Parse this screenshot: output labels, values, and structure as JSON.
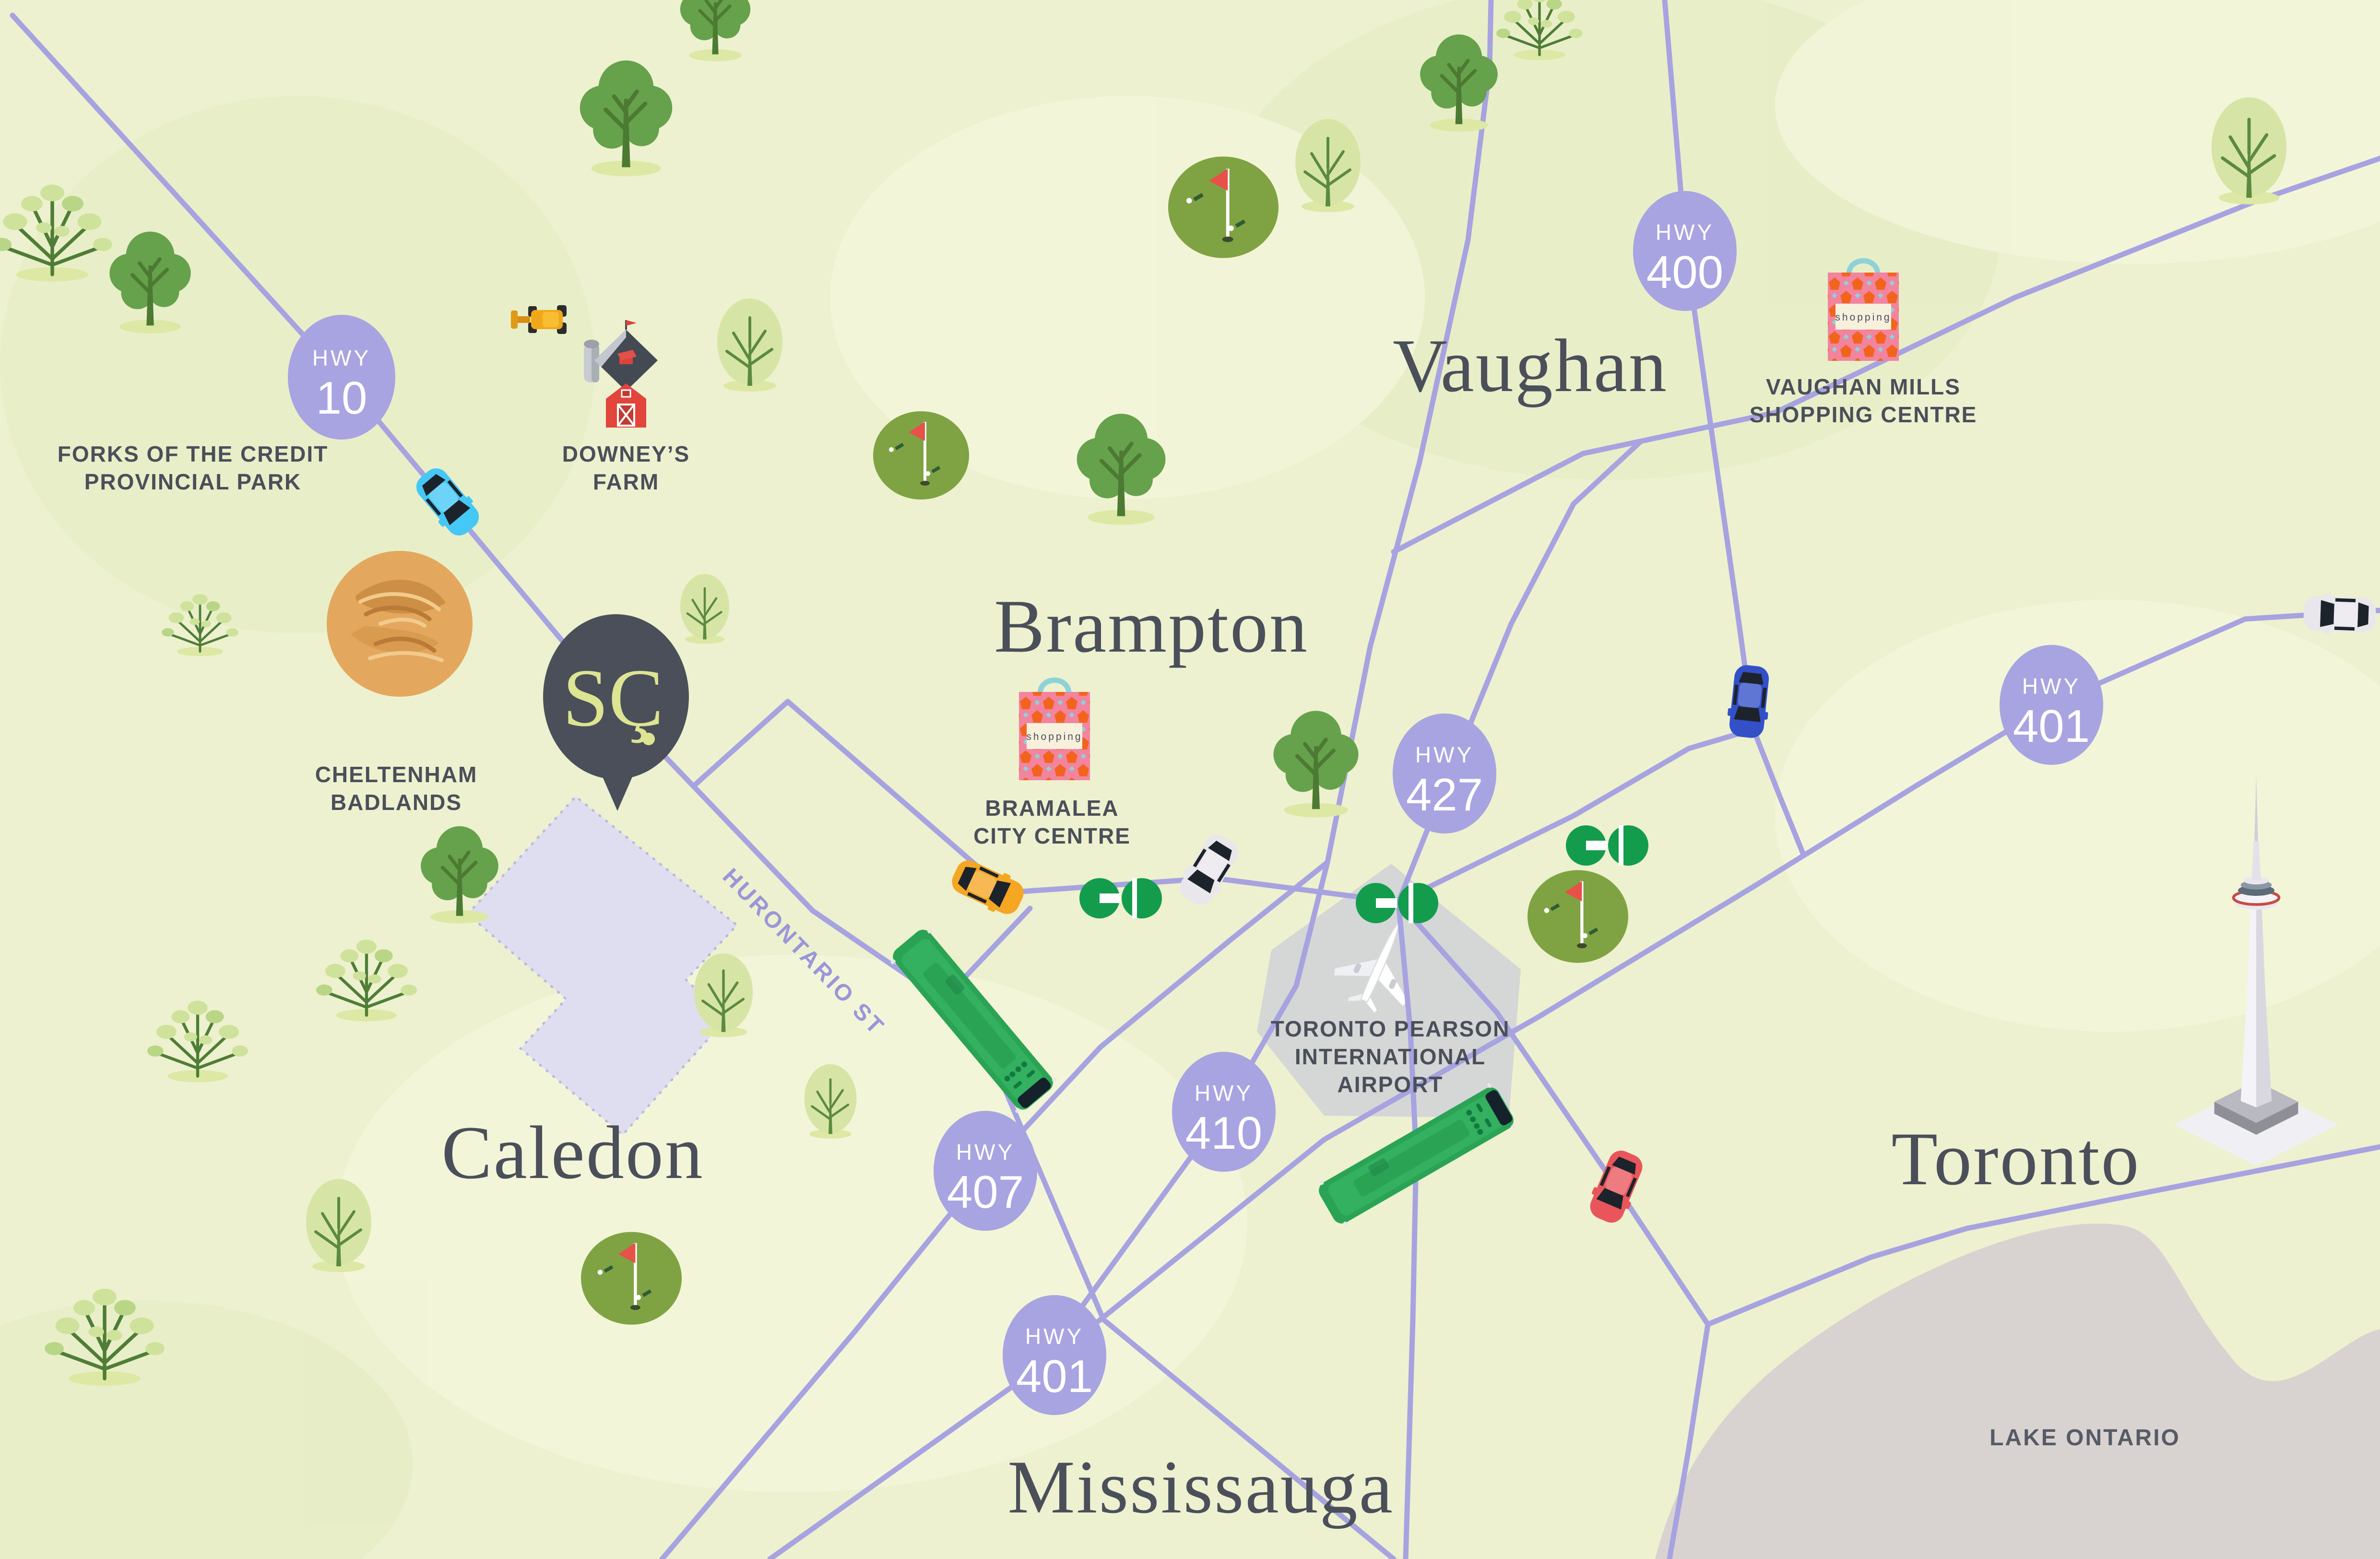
{
  "cities": [
    {
      "name": "Caledon"
    },
    {
      "name": "Brampton"
    },
    {
      "name": "Vaughan"
    },
    {
      "name": "Mississauga"
    },
    {
      "name": "Toronto"
    }
  ],
  "badges": [
    {
      "label": "HWY",
      "number": "10"
    },
    {
      "label": "HWY",
      "number": "400"
    },
    {
      "label": "HWY",
      "number": "427"
    },
    {
      "label": "HWY",
      "number": "401"
    },
    {
      "label": "HWY",
      "number": "407"
    },
    {
      "label": "HWY",
      "number": "410"
    },
    {
      "label": "HWY",
      "number": "401"
    }
  ],
  "pois": [
    {
      "line1": "FORKS OF THE CREDIT",
      "line2": "PROVINCIAL PARK"
    },
    {
      "line1": "DOWNEY’S",
      "line2": "FARM"
    },
    {
      "line1": "CHELTENHAM",
      "line2": "BADLANDS"
    },
    {
      "line1": "BRAMALEA",
      "line2": "CITY CENTRE"
    },
    {
      "line1": "VAUGHAN MILLS",
      "line2": "SHOPPING CENTRE"
    },
    {
      "line1": "TORONTO PEARSON",
      "line2": "INTERNATIONAL",
      "line3": "AIRPORT"
    }
  ],
  "streets": {
    "hurontario": "HURONTARIO ST"
  },
  "water": {
    "lake": "LAKE ONTARIO"
  },
  "pin": {
    "monogram": "SÇ"
  },
  "bags": {
    "label": "shopping"
  },
  "icons": {
    "tree-icon": "stylized map tree",
    "golf-course-icon": "green circle with red flag",
    "go-transit-icon": "green GO logo",
    "shopping-bag-icon": "patterned bag with teal handle",
    "barn-icon": "red barn with silo",
    "tractor-icon": "yellow tractor",
    "airplane-icon": "white plane on runway pad",
    "cn-tower-icon": "isometric CN Tower",
    "car-icon": "top-view car",
    "bus-icon": "green GO bus",
    "location-pin-icon": "dark balloon pin with monogram"
  },
  "colors": {
    "background": "#edf1cf",
    "terrain_light": "#f4f6dc",
    "terrain_green": "#e6eec5",
    "road": "#a7a3e0",
    "badge": "#a8a4e1",
    "badge_text": "#ffffff",
    "label_text": "#4a4f5a",
    "street_label": "#9a96d8",
    "lake": "#d8d3d1",
    "lake_text": "#565b66",
    "go_green": "#149c4d",
    "golf_green": "#7fa342",
    "pin_bg": "#4a4f59",
    "pin_text": "#dde492",
    "parcel": "#deddf2",
    "badlands": "#e3a85e",
    "bag_pink": "#f2849f",
    "bag_orange": "#f2641e",
    "bag_handle": "#8ed2d8"
  }
}
